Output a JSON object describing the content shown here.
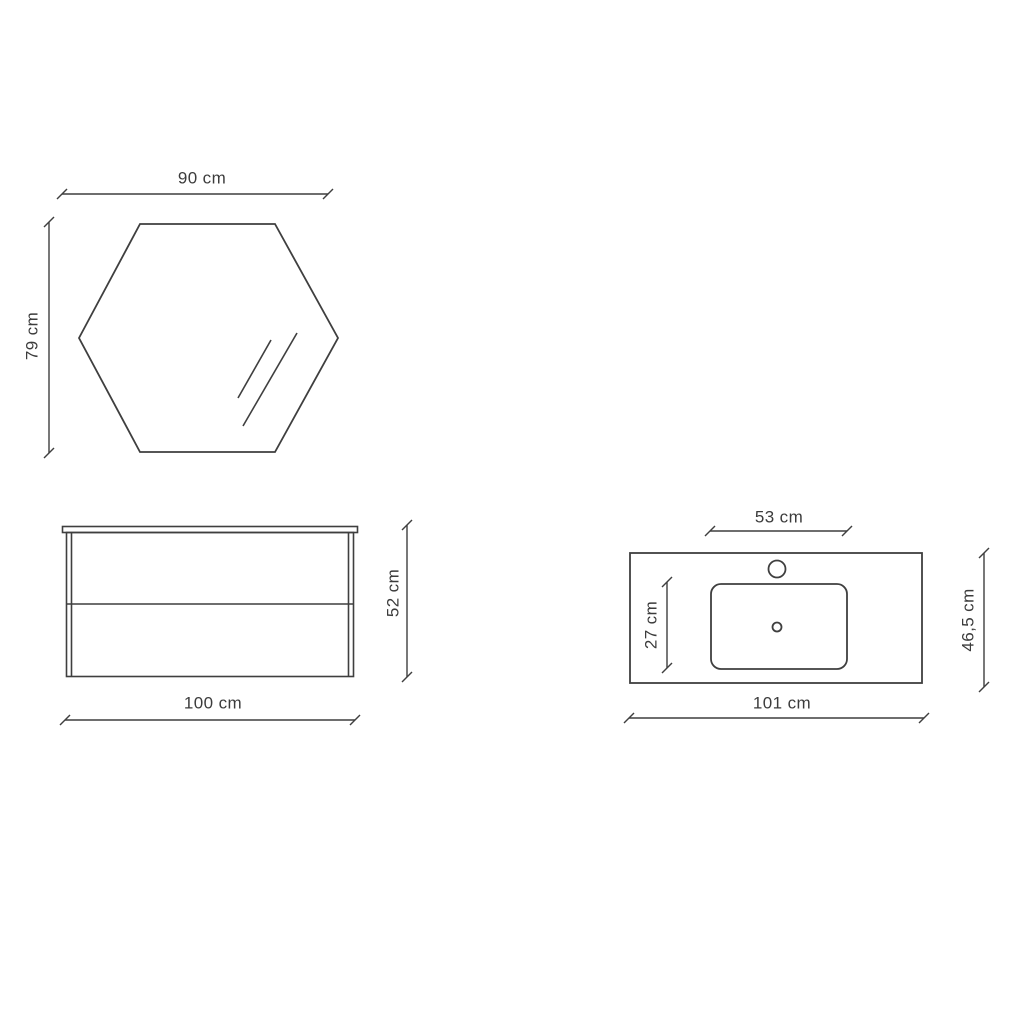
{
  "diagram": {
    "title": "bathroom-vanity-set-dimension-diagram",
    "background_color": "#ffffff",
    "line_color": "#3f3f3f",
    "text_color": "#3c3c3c",
    "unit": "cm",
    "views": {
      "mirror": {
        "shape": "hexagon-front-view",
        "width_label": "90 cm",
        "height_label": "79 cm"
      },
      "cabinet": {
        "shape": "two-drawer-cabinet-front-view",
        "width_label": "100 cm",
        "height_label": "52 cm"
      },
      "washbasin": {
        "shape": "countertop-basin-top-view",
        "width_label": "101 cm",
        "depth_label": "46,5 cm",
        "basin_width_label": "53 cm",
        "basin_depth_label": "27 cm"
      }
    }
  }
}
